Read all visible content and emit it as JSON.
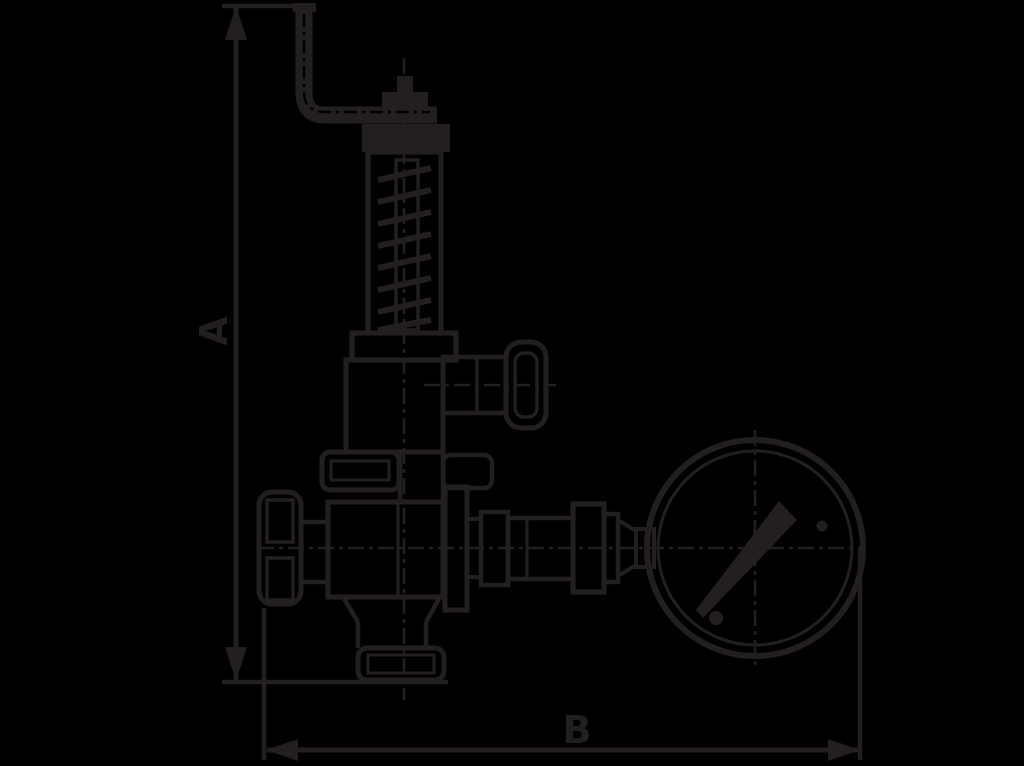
{
  "figure": {
    "type": "technical-line-drawing",
    "subject": "Dimensioned side view of an overflow/safety valve assembly with lifting lever, test knob, handwheel, outlet fittings and pressure gauge",
    "background_color": "#000000",
    "line_color": "#231f20"
  },
  "labels": {
    "dimension_a": "A",
    "dimension_b": "B"
  },
  "dimensions": [
    {
      "name": "A",
      "orientation": "vertical",
      "measures": "overall height from base line to top of lifting lever"
    },
    {
      "name": "B",
      "orientation": "horizontal",
      "measures": "overall width from handwheel left edge to pressure gauge right edge"
    }
  ],
  "components": [
    "lifting-lever",
    "adjusting-stem-and-locknut",
    "spring-housing-with-coil-spring",
    "bonnet",
    "side-test-valve-knob",
    "union-flange",
    "valve-body",
    "handwheel",
    "outlet-fittings",
    "pressure-gauge",
    "bottom-outlet-flange"
  ]
}
